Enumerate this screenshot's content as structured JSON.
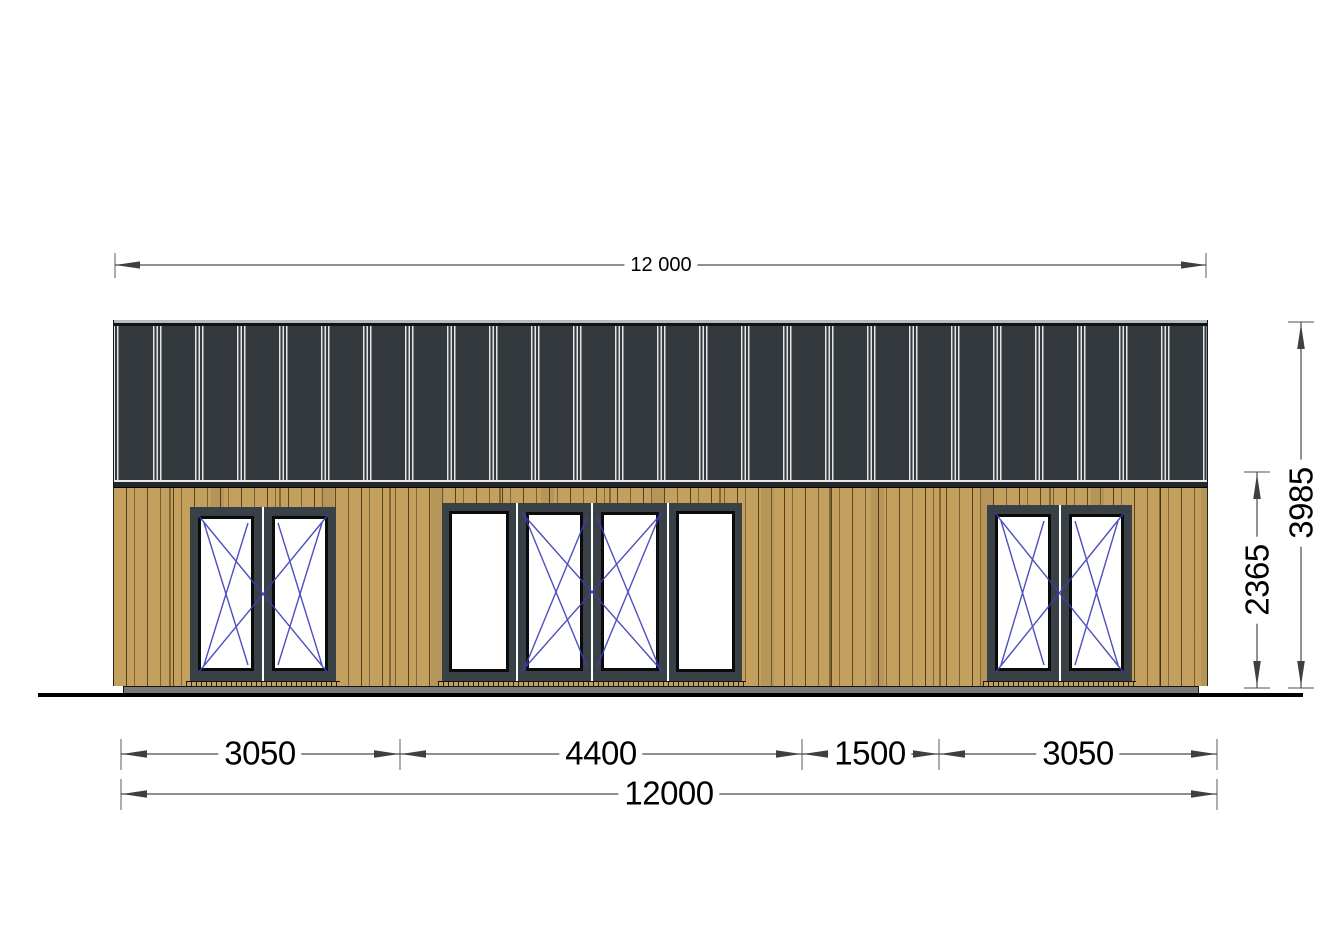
{
  "drawing": {
    "type": "house front elevation",
    "facade_material": "vertical wood cladding",
    "roof_material": "dark standing-seam metal"
  },
  "dimensions": {
    "top_width": "12 000",
    "segments": [
      "3050",
      "4400",
      "1500",
      "3050"
    ],
    "total_width": "12000",
    "wall_height": "2365",
    "total_height": "3985"
  },
  "colors": {
    "roof": "#34393d",
    "roof_seam": "#e3e5e6",
    "wood_cladding": "#c4a05f",
    "window_frame": "#3a4146",
    "glass": "#ffffff",
    "swing_mark_blue": "#3c3cb8",
    "plinth_gray": "#77797c",
    "dimension_line": "#4a4a4a",
    "text": "#000000"
  }
}
